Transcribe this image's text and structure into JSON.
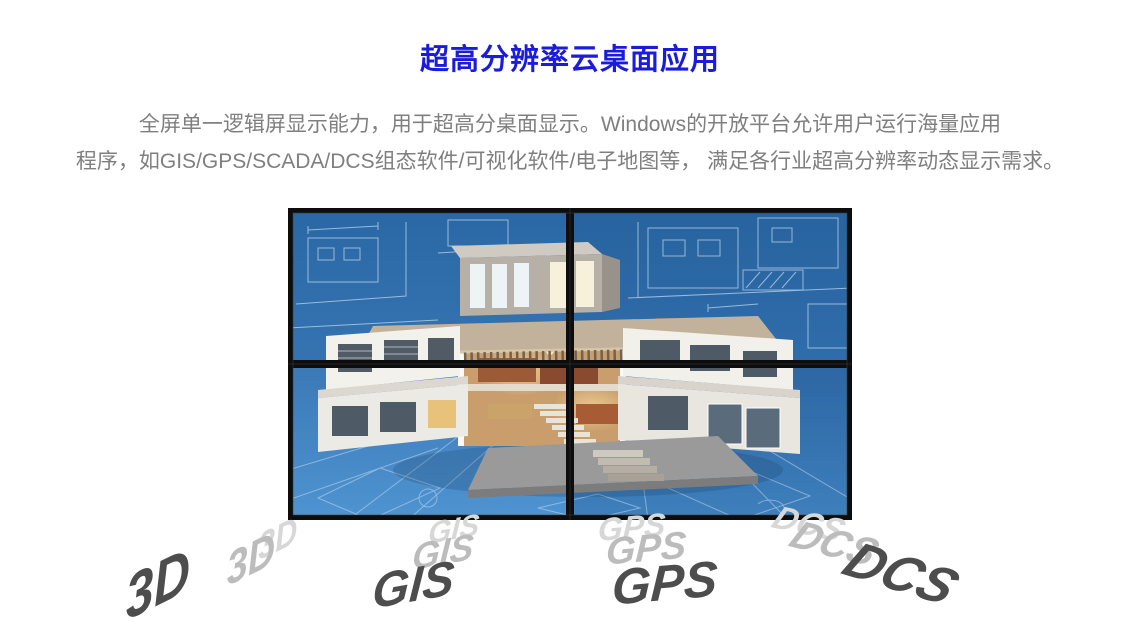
{
  "title": {
    "text": "超高分辨率云桌面应用"
  },
  "paragraph": {
    "line1": "全屏单一逻辑屏显示能力，用于超高分桌面显示。Windows的开放平台允许用户运行海量应用",
    "line2": "程序，如GIS/GPS/SCADA/DCS组态软件/可视化软件/电子地图等， 满足各行业超高分辨率动态显示需求。"
  },
  "video_wall": {
    "layout": "2x2",
    "rows": 2,
    "cols": 2,
    "screen_count": 4,
    "content_description": "3D architectural cutaway villa render displayed across four screens over a blue blueprint background"
  },
  "labels": [
    {
      "text": "3D"
    },
    {
      "text": "GIS"
    },
    {
      "text": "GPS"
    },
    {
      "text": "DCS"
    }
  ],
  "colors": {
    "title-blue": "#1b1bdc",
    "body-gray": "#7f7f7f",
    "label-main": "#4d4d4d",
    "label-ghost1": "#bcbcbc",
    "label-ghost2": "#d7d7d7",
    "bezel": "#0d0d0d",
    "screen-top": "#2a68a5",
    "screen-bottom": "#4a90cf",
    "blueprint-line": "#dcebf8"
  }
}
